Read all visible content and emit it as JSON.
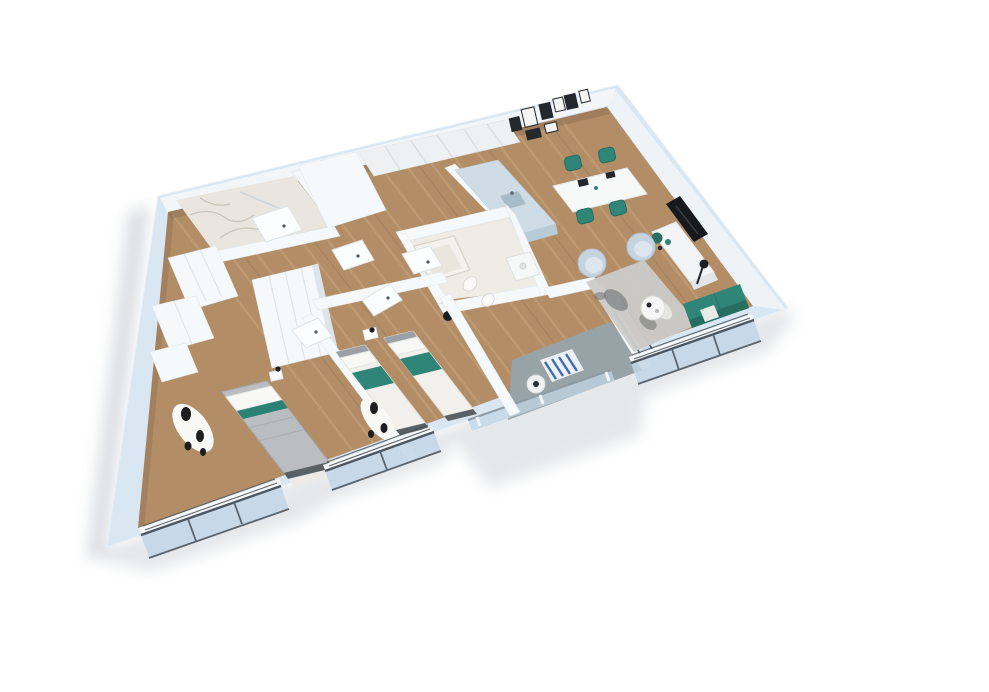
{
  "meta": {
    "width": 989,
    "height": 692
  },
  "palette": {
    "background": "#ffffff",
    "shadow": "#bcc2c8",
    "wall_top": "#d9e7f3",
    "wall_face": "#f2f6f9",
    "partition": "#f6f9fb",
    "wood": "#b28d66",
    "wood_plank": "#c9a87f",
    "marble": "#e9e6df",
    "bath_floor": "#efece6",
    "balcony_floor": "#98a3a8",
    "glass": "#c3d6e6",
    "frame": "#4d5761",
    "teal": "#2f8577",
    "teal_dark": "#266d62",
    "chair_blue": "#c6d4e0",
    "chair_inner": "#dde6ee",
    "rug_gray": "#cbcbc9",
    "rug_blue": "#3f6cb0",
    "tv": "#17191d",
    "console": "#f3f4f5",
    "counter": "#cddce5",
    "counter_side": "#b9cbd6",
    "duvet": "#babdc1",
    "linen": "#f1f0ec",
    "pillow": "#f8f8f6",
    "headboard": "#9aa0a5",
    "bedframe": "#596066",
    "cow_white": "#f8f8f6",
    "cow_black": "#1e1e20",
    "cabinet": "#eef1f4",
    "gallery_dark": "#24282d",
    "gallery_light": "#f4f4f3",
    "door": "#fbfdfe",
    "sill": "#f7fafc",
    "lamp": "#1b1e22",
    "plant": "#2b6f63",
    "balustrade_rail": "#8e9aa4"
  },
  "apartment": {
    "style": "3d-isometric-floorplan-render",
    "rooms": [
      {
        "id": "entry-hall",
        "floor": "wood",
        "objects": [
          "wardrobe",
          "dresser",
          "doors"
        ]
      },
      {
        "id": "bathroom-small",
        "floor": "marble",
        "objects": [
          "shower-glass",
          "door"
        ]
      },
      {
        "id": "kitchen-dining",
        "floor": "wood",
        "objects": [
          "upper-cabinets",
          "l-counter",
          "sink",
          "gallery-wall",
          "dining-table",
          "chairs"
        ]
      },
      {
        "id": "living-room",
        "floor": "wood",
        "objects": [
          "tv",
          "tv-console",
          "armchair",
          "armchair",
          "coffee-table",
          "rug",
          "sofa",
          "floor-lamp",
          "plant"
        ]
      },
      {
        "id": "bathroom-main",
        "floor": "stone",
        "objects": [
          "bathtub",
          "toilet",
          "bidet",
          "vanity",
          "towel-stand"
        ]
      },
      {
        "id": "bedroom-double",
        "floor": "wood",
        "objects": [
          "double-bed",
          "cowhide-rug",
          "wardrobe",
          "bench",
          "nightstand",
          "lamp"
        ]
      },
      {
        "id": "bedroom-twin",
        "floor": "wood",
        "objects": [
          "single-bed",
          "single-bed",
          "cowhide-rug",
          "nightstand",
          "lamp"
        ]
      },
      {
        "id": "balcony",
        "floor": "concrete",
        "objects": [
          "round-table",
          "striped-rug",
          "glass-balustrade"
        ]
      }
    ],
    "window_bays": 3,
    "gallery_frames": 8,
    "dining_chairs": 4
  }
}
